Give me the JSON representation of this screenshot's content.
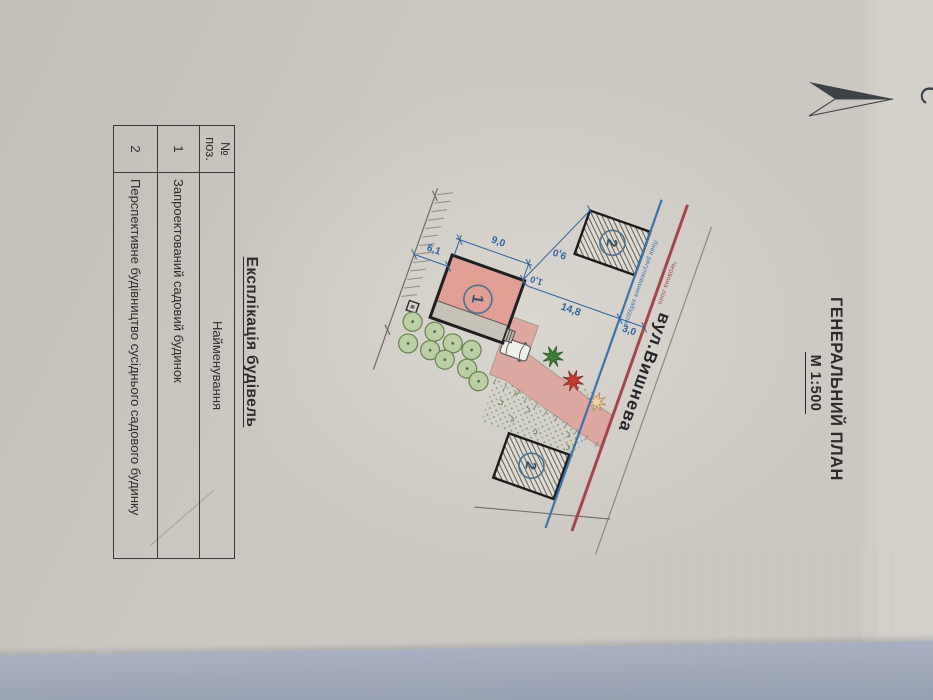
{
  "compass": {
    "north_label": "С"
  },
  "title_block": {
    "title": "ГЕНЕРАЛЬНИЙ ПЛАН",
    "scale": "М 1:500"
  },
  "site_plan": {
    "street_name": "вул.Вишнева",
    "regulation_line_label": "Лінія регулювання забудови",
    "red_line_label": "Червона лінія",
    "building_1_number": "1",
    "building_2_number": "2",
    "dimensions": {
      "building_side": "9,0",
      "rear_setback": "6,1",
      "gap_to_neighbor": "9,0",
      "corner_offset": "1,0",
      "front_setback": "14,8",
      "red_line_offset": "3,0"
    }
  },
  "explication_table": {
    "title": "Експлікація будівель",
    "col_position_line1": "№",
    "col_position_line2": "поз.",
    "col_name_header": "Найменування",
    "rows": [
      {
        "position": "1",
        "name": "Запроектований садовий будинок"
      },
      {
        "position": "2",
        "name": "Перспективне будівництво сусіднього садового будинку"
      }
    ]
  },
  "colors": {
    "regulation_line": "#3c74aa",
    "red_line": "#a4464e",
    "building_fill": "#e0a096",
    "driveway_fill": "#dca89f",
    "tree_fill": "#bccfa4",
    "desk_surface": "#9aa3b5",
    "paper": "#ccc8c1"
  }
}
